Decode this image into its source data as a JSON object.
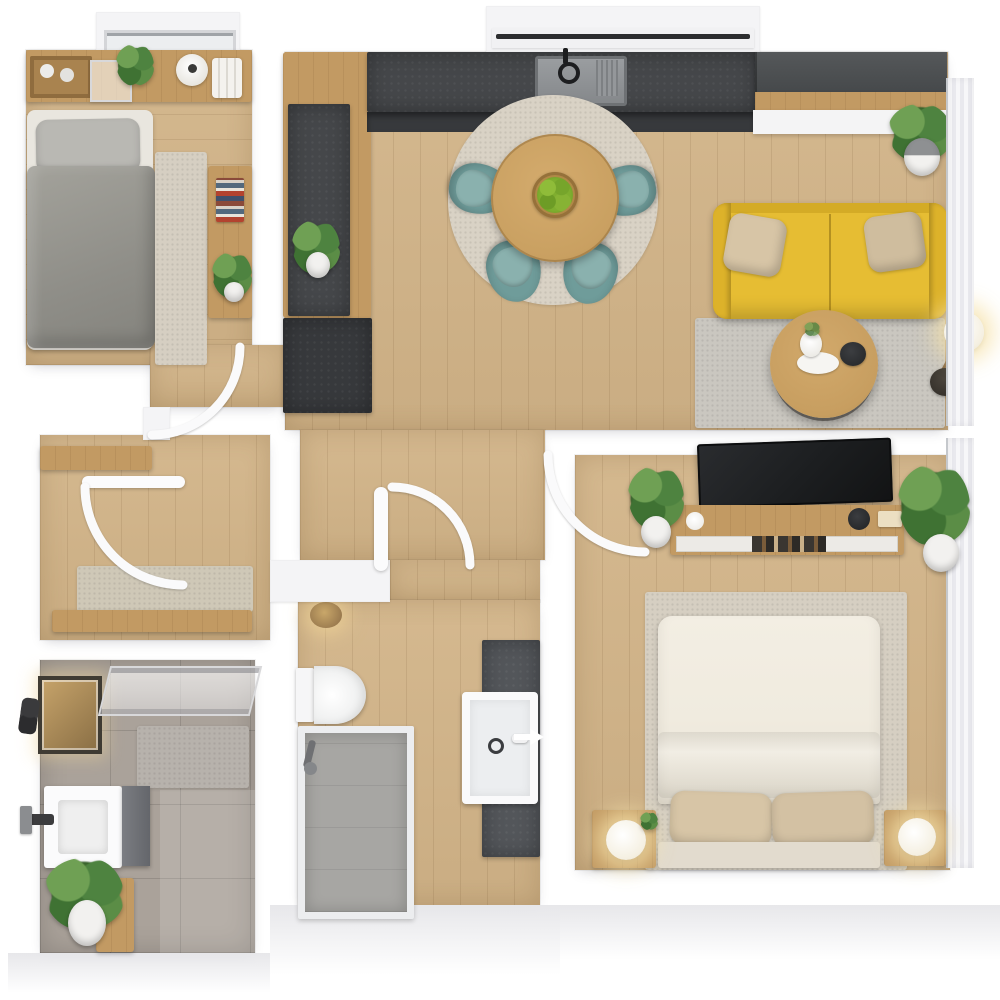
{
  "meta": {
    "title": "3D apartment floor plan — top-down view",
    "type": "floor-plan-render"
  },
  "palette": {
    "page-bg": "#ffffff",
    "wall": "#f4f4f6",
    "wall-edge": "#e2e2e6",
    "wood-floor": "#d2b488",
    "wood-furniture": "#c29a63",
    "counter-dark": "#45474a",
    "cabinet-dark": "#37393c",
    "sofa-yellow": "#e6bd33",
    "sofa-yellow-dark": "#d4ab26",
    "cushion-beige": "#d7c5a6",
    "chair-teal": "#6f9c9a",
    "chair-teal-light": "#8ab1ae",
    "rug-dining": "#d9d2c5",
    "rug-living": "#cac7c0",
    "rug-bed": "#d6cfc2",
    "rug-mat": "#cfc8b7",
    "duvet-grey": "#97968f",
    "pillow-grey": "#b9b8b3",
    "sheet-white": "#e9e6df",
    "duvet-cream": "#f0ebdf",
    "bed-base": "#e2dbce",
    "tile-grey": "#aaa29a",
    "shower-grey": "#a7a6a3",
    "vanity-dark": "#53565a",
    "tv-black": "#1c1e20",
    "plant-green": "#4f7f3c",
    "plant-green-dark": "#39622c",
    "glow-warm": "#f4e3c2",
    "apple-green": "#7fae2f",
    "table-wood": "#c9a061"
  },
  "scene": {
    "rooms": [
      {
        "label": "Single bedroom",
        "furniture": [
          "single bed with grey duvet and grey pillow",
          "headboard shelf with cups, glass box, plant, vase and books",
          "bedside rug",
          "side cabinet with stacked colorful books and potted plant",
          "window in top wall"
        ]
      },
      {
        "label": "Open-plan kitchen, dining and living room",
        "furniture": [
          "dark L-shaped kitchen countertop",
          "sink with black faucet",
          "tall wood cabinet column with dark counter inset and plant",
          "dark base cabinet",
          "kitchen window",
          "round wooden dining table",
          "bowl of green apples",
          "4 teal tub chairs",
          "round beige rug",
          "yellow sofa with 2 beige cushions",
          "round wooden coffee table with vase, plate and bowl",
          "grey rug",
          "floor lamp with white globe",
          "potted plant",
          "dark wall cabinets with wood trim and white shelf",
          "window band with curtains"
        ]
      },
      {
        "label": "Master bedroom",
        "furniture": [
          "double bed with cream duvet",
          "2 beige pillows",
          "2 wooden nightstands with glowing round lamps",
          "wall TV",
          "wooden TV console with white drawers and media shelf",
          "2 potted plants",
          "beige rug",
          "window band with curtains"
        ]
      },
      {
        "label": "Bathroom",
        "furniture": [
          "glass shower screen",
          "textured shower mat",
          "white vanity sink with dark faucet",
          "grey cabinet",
          "lit window with dark frame",
          "black wall lamp",
          "potted plant",
          "wooden board"
        ]
      },
      {
        "label": "Shower room / WC",
        "furniture": [
          "wall-hung toilet",
          "walk-in shower with glass frame",
          "warm ceiling light",
          "white washbasin on dark tiled strip",
          "white direction arrow"
        ]
      },
      {
        "label": "Entry hall",
        "furniture": [
          "wooden wall shelf",
          "speckled door mat",
          "wooden bench",
          "entry door"
        ]
      }
    ],
    "doors": [
      "single bedroom door swing",
      "entry door swing",
      "wc door swing",
      "master bedroom door swing"
    ],
    "icons": [
      "arrow-right-icon",
      "faucet-icon",
      "drain-icon"
    ]
  }
}
